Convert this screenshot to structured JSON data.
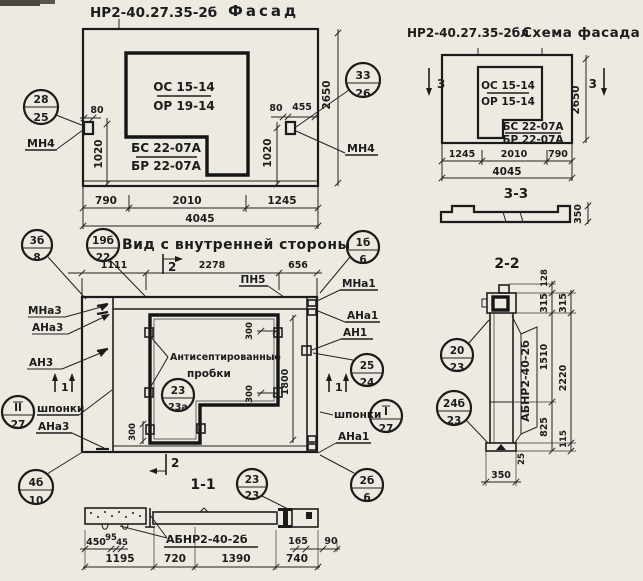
{
  "palette": {
    "paper": "#edeae2",
    "ink": "#1c1c1c"
  },
  "facade": {
    "code": "НР2-40.27.35-2б",
    "title": "Фасад",
    "opening_mark_top": "ОС 15-14",
    "opening_mark_bottom": "ОР 19-14",
    "panel_mark_top": "БС 22-07А",
    "panel_mark_bottom": "БР 22-07А",
    "callout_left_top": "28",
    "callout_left_bottom": "25",
    "callout_right_top": "33",
    "callout_right_bottom": "26",
    "anchor_label_left": "МН4",
    "anchor_label_right": "МН4",
    "dim_left_offset": "80",
    "dim_left_height": "1020",
    "dim_right_offset": "80",
    "dim_right_width": "455",
    "dim_right_height": "1020",
    "dim_height": "2650",
    "dim_b1": "790",
    "dim_b2": "2010",
    "dim_b3": "1245",
    "dim_total": "4045"
  },
  "schema": {
    "code": "НР2-40.27.35-2бл",
    "title": "Схема фасада",
    "opening_mark_top": "ОС 15-14",
    "opening_mark_bottom": "ОР 15-14",
    "panel_mark_top": "БС 22-07А",
    "panel_mark_bottom": "БР 22-07А",
    "section_mark_left": "3",
    "section_mark_right": "3",
    "dim_height": "2650",
    "dim_b1": "1245",
    "dim_b2": "2010",
    "dim_b3": "790",
    "dim_total": "4045"
  },
  "section33": {
    "title": "3-3",
    "dim_thickness": "350"
  },
  "inner_view": {
    "title": "Вид с внутренней стороны",
    "dim_t1": "1111",
    "dim_t2": "2278",
    "dim_t3": "656",
    "section_mark_top": "2",
    "section_mark_bottom": "2",
    "section_mark_left": "1",
    "section_mark_right": "1",
    "beam_label": "ПН5",
    "note_line1": "Антисептированные",
    "note_line2": "пробки",
    "dim_opening_height": "1800",
    "plug_dims": [
      "300",
      "300",
      "300"
    ],
    "labels_left": {
      "l1": "МНа3",
      "l2": "АНа3",
      "l3": "АН3",
      "l4": "шпонки",
      "l5": "АНа3"
    },
    "labels_right": {
      "r1": "МНа1",
      "r2": "АНа1",
      "r3": "АН1",
      "r4": "шпонки",
      "r5": "АНа1"
    },
    "callouts": {
      "c3b8_top": "3б",
      "c3b8_bottom": "8",
      "c19b22_top": "19б",
      "c19b22_bottom": "22",
      "c1b6_top": "1б",
      "c1b6_bottom": "6",
      "c2524_top": "25",
      "c2524_bottom": "24",
      "cII27_top": "II",
      "cII27_bottom": "27",
      "cI27_top": "I",
      "cI27_bottom": "27",
      "c2323a_top": "23",
      "c2323a_bottom": "23а",
      "c4b10_top": "4б",
      "c4b10_bottom": "10",
      "c2b6_top": "2б",
      "c2b6_bottom": "6",
      "c2323_top": "23",
      "c2323_bottom": "23"
    }
  },
  "section11": {
    "title": "1-1",
    "beam_label": "АБНР2-40-2б",
    "dim_a1": "450",
    "dim_a2": "95",
    "dim_a3": "45",
    "dim_a4": "165",
    "dim_a5": "90",
    "dim_b1": "1195",
    "dim_b2": "720",
    "dim_b3": "1390",
    "dim_b4": "740"
  },
  "section22": {
    "title": "2-2",
    "beam_label": "АБНР2-40-2б",
    "dim_top": "128",
    "col1": [
      "315",
      "1510",
      "825"
    ],
    "col2": [
      "315",
      "2220",
      "115"
    ],
    "dim_base_offset": "25",
    "dim_base": "350",
    "callout1_top": "20",
    "callout1_bottom": "23",
    "callout2_top": "24б",
    "callout2_bottom": "23"
  }
}
